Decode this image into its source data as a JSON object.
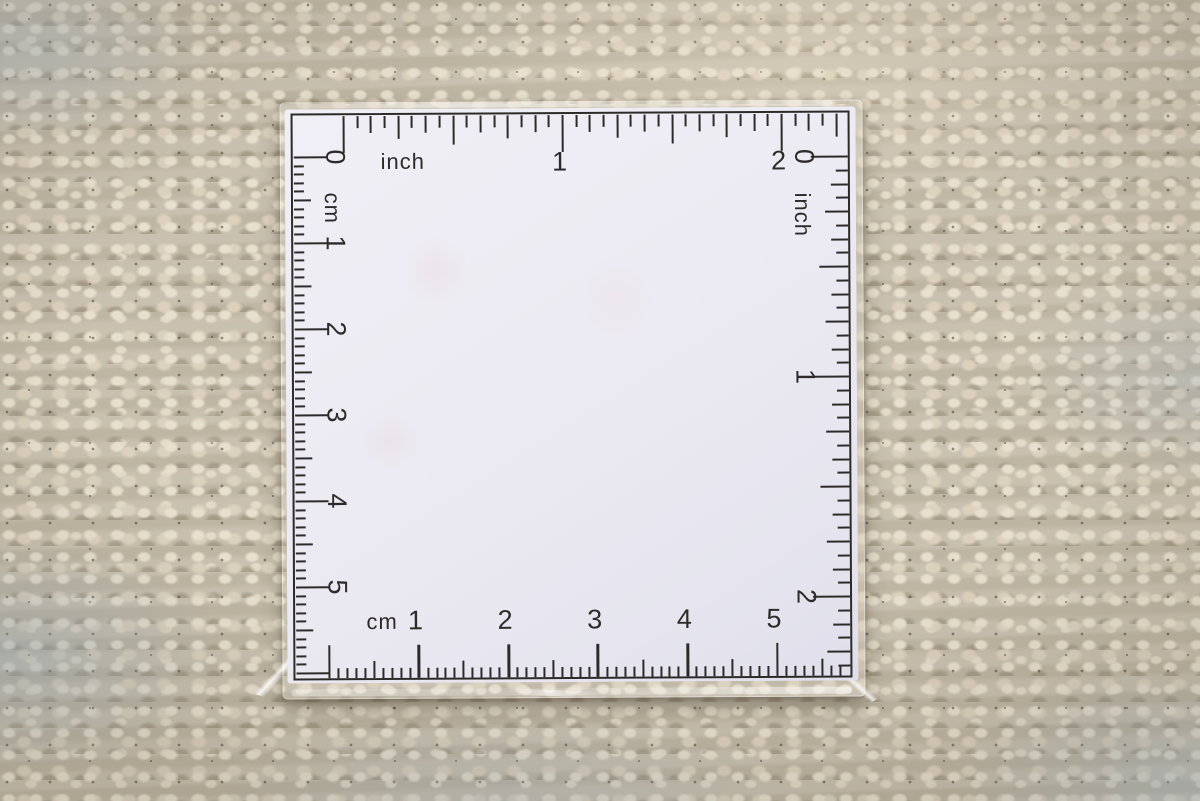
{
  "ruler": {
    "ink_color": "#2d2b28",
    "card_color": "#eceaf2",
    "scales": {
      "top": {
        "edge": "top",
        "unit_label": "inch",
        "numerals": [
          "1",
          "2"
        ],
        "first_numeral_unit": 1,
        "subdivisions_per_unit": 16,
        "length_units": 2
      },
      "right": {
        "edge": "right",
        "unit_label": "inch",
        "numerals": [
          "0",
          "1",
          "2"
        ],
        "first_numeral_unit": 0,
        "subdivisions_per_unit": 16,
        "length_units": 2
      },
      "left": {
        "edge": "left",
        "unit_label": "cm",
        "numerals": [
          "0",
          "1",
          "2",
          "3",
          "4",
          "5"
        ],
        "first_numeral_unit": 0,
        "subdivisions_per_unit": 10,
        "length_units": 5
      },
      "bottom": {
        "edge": "bottom",
        "unit_label": "cm",
        "numerals": [
          "1",
          "2",
          "3",
          "4",
          "5"
        ],
        "first_numeral_unit": 1,
        "subdivisions_per_unit": 10,
        "length_units": 5
      }
    }
  },
  "background": {
    "fabric_base": "#c6bdab",
    "fabric_cream": "#e8e0ce",
    "fabric_shadow": "#877b64",
    "fabric_blue_gray": "#9eacb6",
    "card_shadow": "#443b2c"
  }
}
